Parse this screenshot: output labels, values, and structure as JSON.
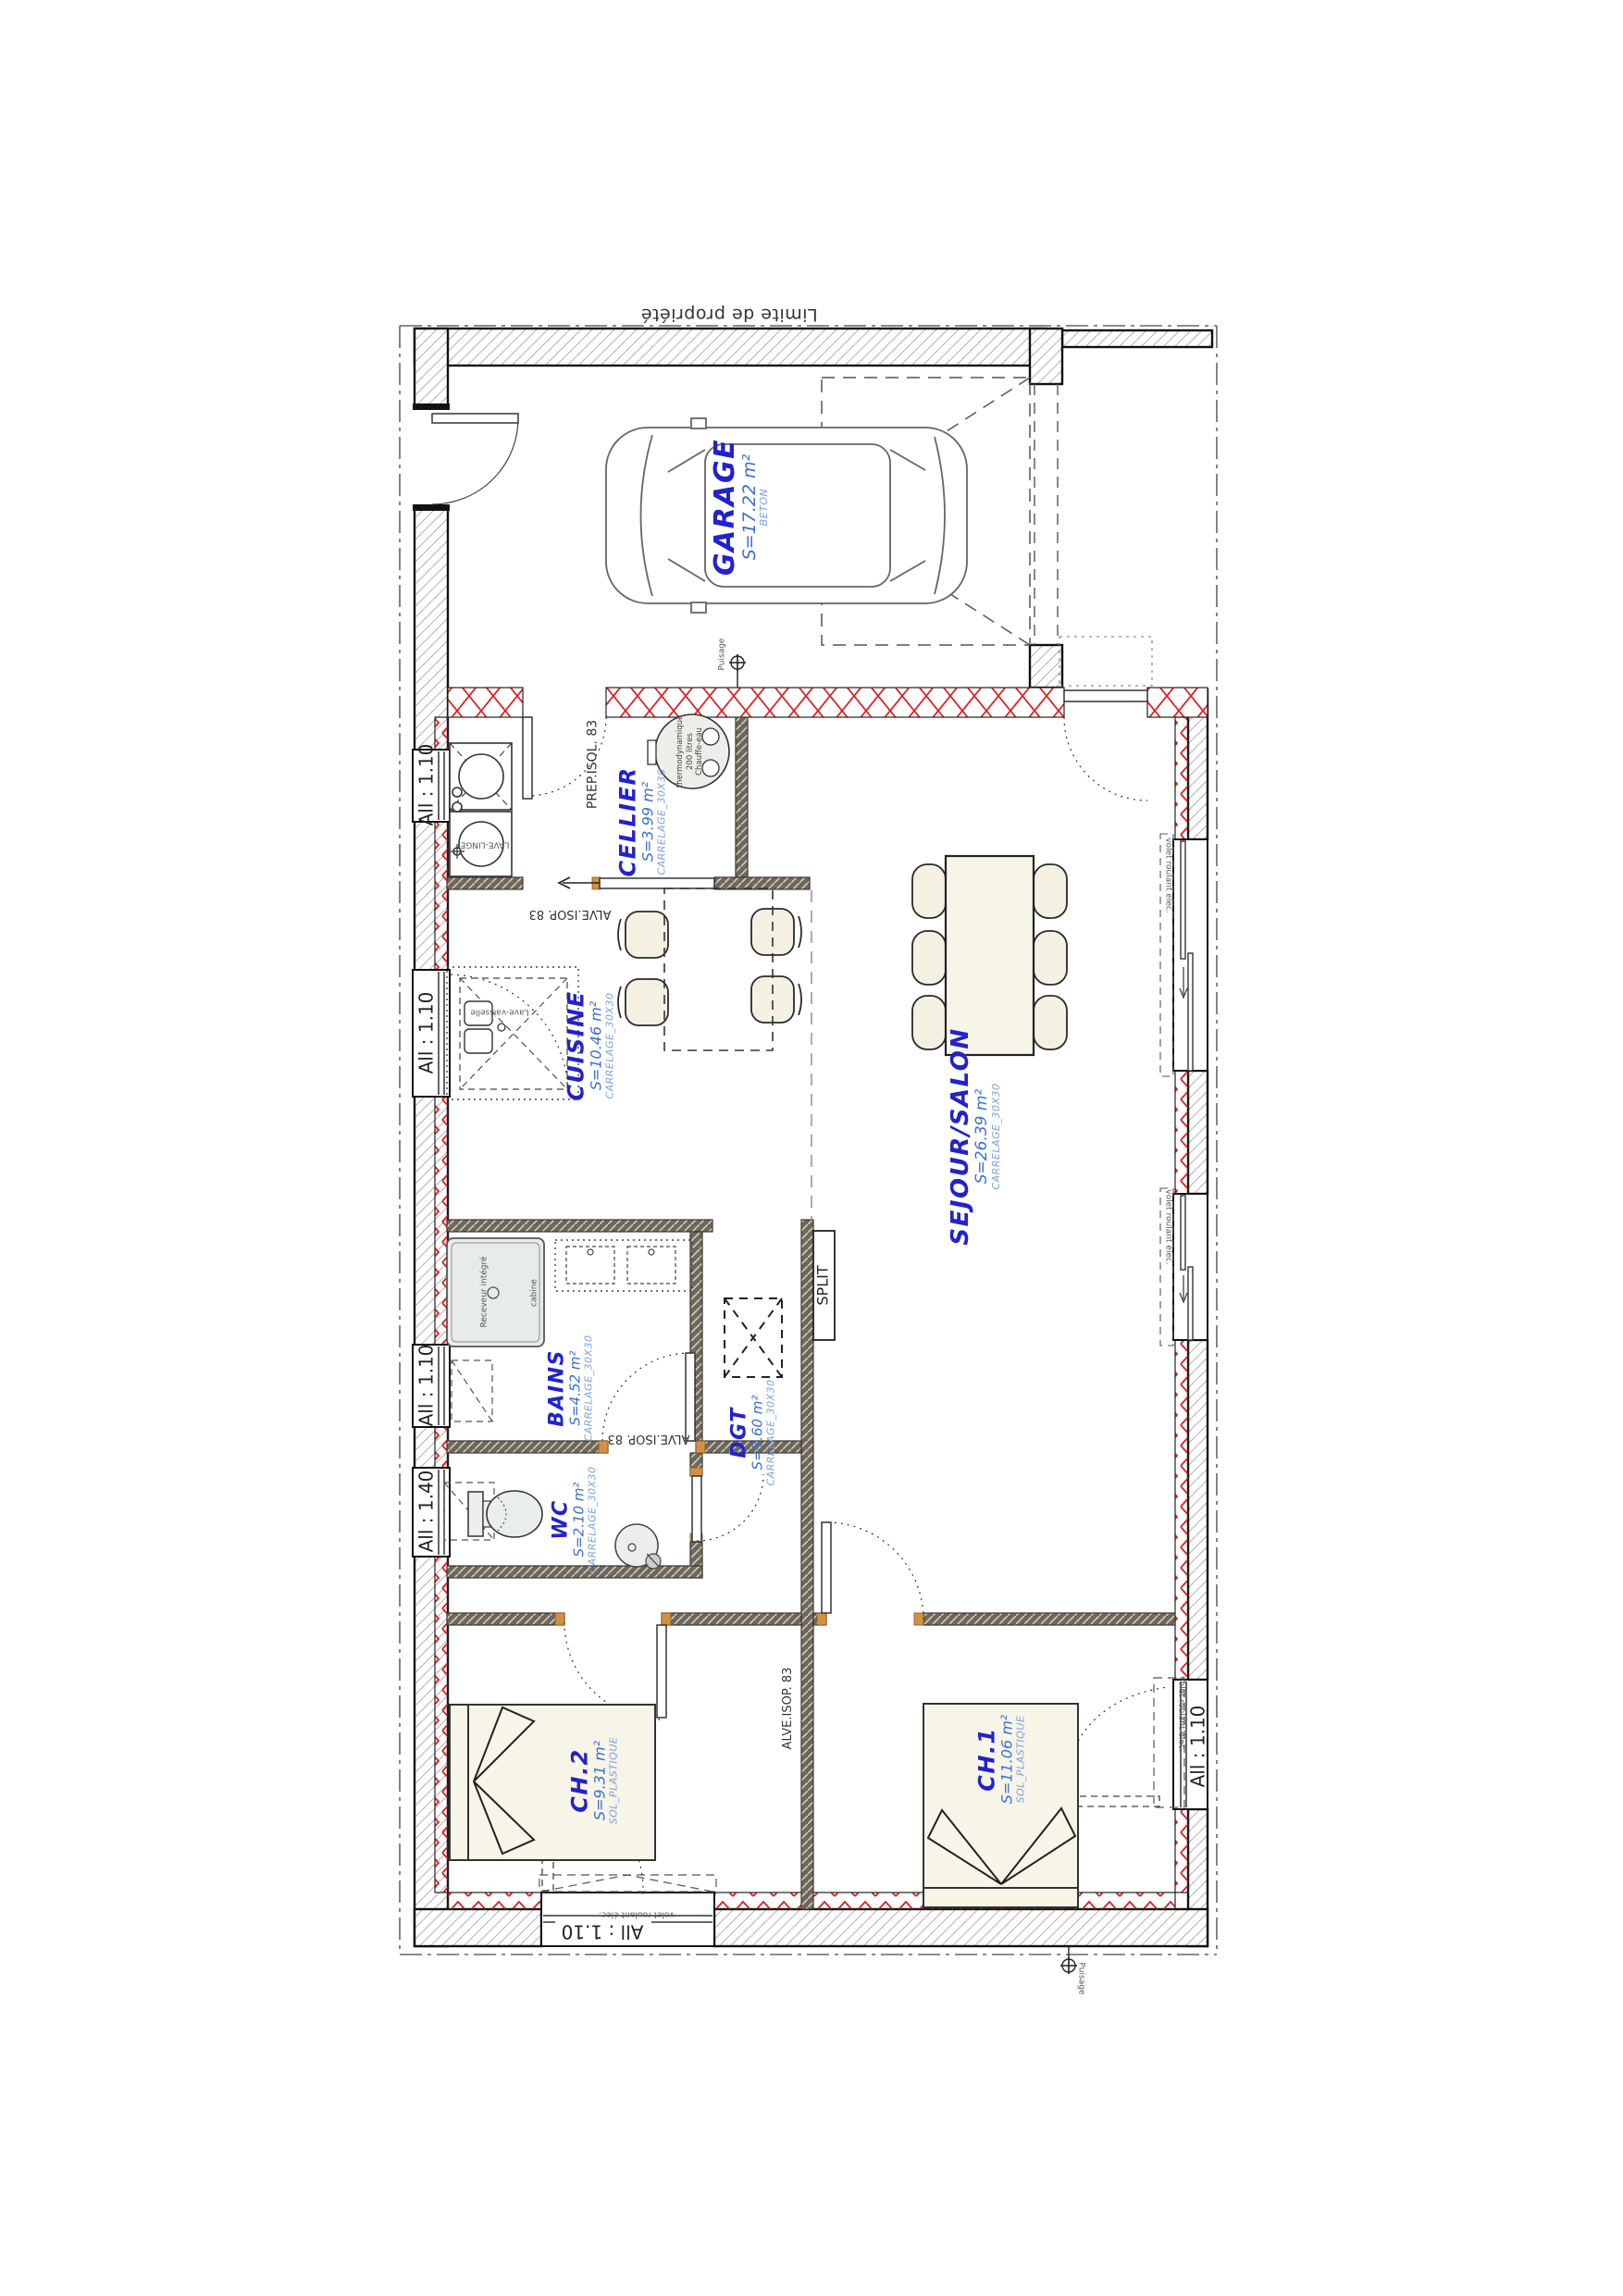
{
  "plan": {
    "boundary_label": "Limite de propriété",
    "rooms": [
      {
        "name": "GARAGE",
        "area": "S=17.22 m²",
        "floor": "BETON"
      },
      {
        "name": "CELLIER",
        "area": "S=3.99 m²",
        "floor": "CARRELAGE_30X30"
      },
      {
        "name": "CUISINE",
        "area": "S=10.46 m²",
        "floor": "CARRELAGE_30X30"
      },
      {
        "name": "SEJOUR/SALON",
        "area": "S=26.39 m²",
        "floor": "CARRELAGE_30X30"
      },
      {
        "name": "BAINS",
        "area": "S=4.52 m²",
        "floor": "CARRELAGE_30X30"
      },
      {
        "name": "DGT",
        "area": "S=3.60 m²",
        "floor": "CARRELAGE_30X30"
      },
      {
        "name": "WC",
        "area": "S=2.10 m²",
        "floor": "CARRELAGE_30X30"
      },
      {
        "name": "CH.2",
        "area": "S=9.31 m²",
        "floor": "SOL_PLASTIQUE"
      },
      {
        "name": "CH.1",
        "area": "S=11.06 m²",
        "floor": "SOL_PLASTIQUE"
      }
    ],
    "window_labels": {
      "a110": "All : 1.10",
      "a140": "All : 1.40"
    },
    "shutter_label": "volet roulant élec.",
    "annotations": {
      "prep_isol": "PREP.ISOL. 83",
      "alve_isop": "ALVE.ISOP. 83",
      "split": "SPLIT",
      "puisage": "Puisage",
      "shower_tray": "Receveur intégré",
      "shower_cabin": "cabine",
      "dishwasher": "Lave-vaisselle",
      "washer": "LAVE-LINGE",
      "water_heater_l1": "thermodynamique",
      "water_heater_l2": "200 litres",
      "water_heater_l3": "Chauffe-eau"
    },
    "colors": {
      "room_name": "#2222cd",
      "room_area": "#3b6fd4",
      "room_floor": "#7d9fe0",
      "insulation_red": "#e02020",
      "partition_dark": "#6e675c",
      "door_frame_orange": "#d29044"
    }
  }
}
